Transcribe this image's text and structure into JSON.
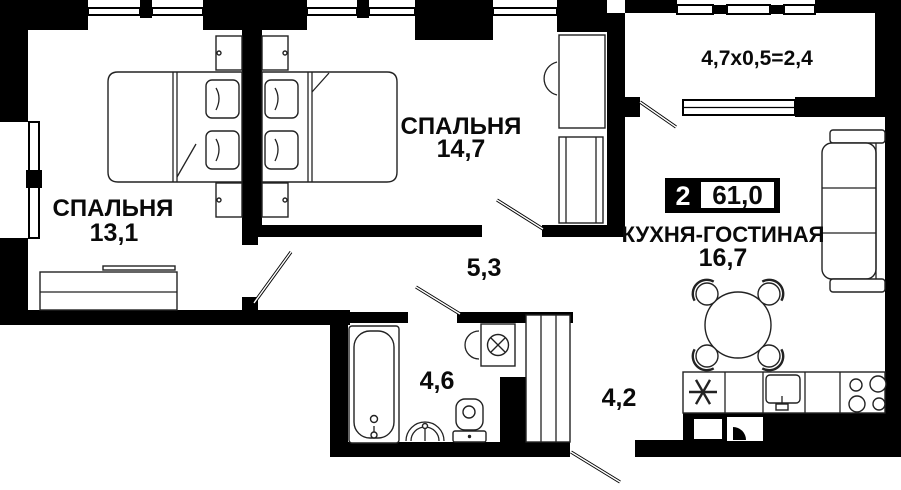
{
  "plan": {
    "badge": {
      "rooms_count": "2",
      "total_area": "61,0"
    },
    "rooms": {
      "bedroom_left": {
        "name": "СПАЛЬНЯ",
        "area": "13,1"
      },
      "bedroom_top": {
        "name": "СПАЛЬНЯ",
        "area": "14,7"
      },
      "kitchen_living": {
        "name": "КУХНЯ-ГОСТИНАЯ",
        "area": "16,7"
      },
      "hallway": {
        "area": "5,3"
      },
      "bathroom": {
        "area": "4,6"
      },
      "entry": {
        "area": "4,2"
      },
      "balcony": {
        "size_formula": "4,7х0,5=2,4"
      }
    },
    "colors": {
      "wall": "#000000",
      "background": "#ffffff",
      "outline": "#222222"
    }
  }
}
